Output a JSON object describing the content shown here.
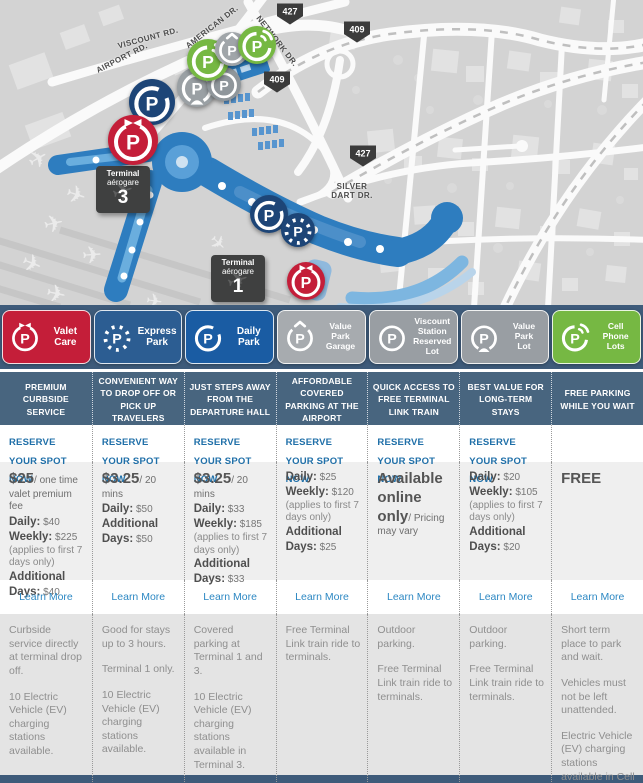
{
  "map": {
    "road_labels": [
      {
        "text": "VISCOUNT RD.",
        "x": 148,
        "y": 38,
        "angle": -15,
        "wrap": false
      },
      {
        "text": "AMERICAN DR.",
        "x": 212,
        "y": 27,
        "angle": -38,
        "wrap": false
      },
      {
        "text": "NETWORK DR.",
        "x": 277,
        "y": 41,
        "angle": 52,
        "wrap": false
      },
      {
        "text": "AIRPORT RD.",
        "x": 122,
        "y": 58,
        "angle": -27,
        "wrap": false
      },
      {
        "text": "SILVER DART DR.",
        "x": 352,
        "y": 191,
        "angle": 0,
        "wrap": true
      }
    ],
    "shields": [
      {
        "label": "427",
        "x": 290,
        "y": 14
      },
      {
        "label": "409",
        "x": 357,
        "y": 32
      },
      {
        "label": "409",
        "x": 277,
        "y": 82
      },
      {
        "label": "427",
        "x": 363,
        "y": 156
      }
    ],
    "terminal_labels": [
      {
        "line1": "Terminal",
        "line2": "aérogare",
        "number": "3",
        "x": 96,
        "y": 166
      },
      {
        "line1": "Terminal",
        "line2": "aérogare",
        "number": "1",
        "x": 211,
        "y": 255
      }
    ],
    "markers": [
      {
        "id": "daily-park-t3",
        "variant": "daily",
        "color": "#1d4577",
        "x": 152,
        "y": 102,
        "d": 46
      },
      {
        "id": "valet-care-t3",
        "variant": "valet",
        "color": "#c41e39",
        "x": 133,
        "y": 140,
        "d": 50
      },
      {
        "id": "value-park-lot",
        "variant": "value-lot",
        "color": "#9aa0a4",
        "x": 197,
        "y": 87,
        "d": 40
      },
      {
        "id": "viscount-station",
        "variant": "viscount",
        "color": "#8f969b",
        "x": 224,
        "y": 84,
        "d": 34
      },
      {
        "id": "cell-phone-lot-1",
        "variant": "cell",
        "color": "#76b843",
        "x": 208,
        "y": 60,
        "d": 42
      },
      {
        "id": "value-park-garage",
        "variant": "garage",
        "color": "#a0a5a9",
        "x": 232,
        "y": 49,
        "d": 34
      },
      {
        "id": "cell-phone-lot-2",
        "variant": "cell",
        "color": "#76b843",
        "x": 257,
        "y": 45,
        "d": 38
      },
      {
        "id": "daily-park-t1",
        "variant": "daily",
        "color": "#1d4577",
        "x": 269,
        "y": 214,
        "d": 38
      },
      {
        "id": "express-park-t1",
        "variant": "express",
        "color": "#1d4577",
        "x": 298,
        "y": 230,
        "d": 34
      },
      {
        "id": "valet-care-t1",
        "variant": "valet",
        "color": "#c41e39",
        "x": 306,
        "y": 281,
        "d": 38
      }
    ]
  },
  "legend": {
    "background": "#3e5b7a",
    "items": [
      {
        "id": "valet-care",
        "label": "Valet\nCare",
        "color": "#c41e39",
        "variant": "valet"
      },
      {
        "id": "express-park",
        "label": "Express\nPark",
        "color": "#2c5d92",
        "variant": "express"
      },
      {
        "id": "daily-park",
        "label": "Daily\nPark",
        "color": "#1a5ca3",
        "variant": "daily"
      },
      {
        "id": "value-park-garage",
        "label": "Value\nPark\nGarage",
        "color": "#a7abaf",
        "variant": "garage"
      },
      {
        "id": "viscount-station-reserved-lot",
        "label": "Viscount\nStation\nReserved Lot",
        "color": "#999ea3",
        "variant": "viscount"
      },
      {
        "id": "value-park-lot",
        "label": "Value\nPark\nLot",
        "color": "#999ea3",
        "variant": "value-lot"
      },
      {
        "id": "cell-phone-lots",
        "label": "Cell\nPhone\nLots",
        "color": "#76b843",
        "variant": "cell"
      }
    ]
  },
  "columns": [
    {
      "id": "valet-care",
      "header": "PREMIUM CURBSIDE SERVICE",
      "reserve": "RESERVE YOUR SPOT NOW",
      "pricing": [
        {
          "lead": "$25",
          "rest": "/ one time valet premium fee"
        },
        {
          "label": "Daily:",
          "value": "$40"
        },
        {
          "label": "Weekly:",
          "value": "$225"
        },
        {
          "note": "(applies to first 7 days only)"
        },
        {
          "label": "Additional Days:",
          "value": "$40"
        }
      ],
      "learn_more": "Learn More",
      "description": [
        "Curbside service directly at terminal drop off.",
        "10 Electric Vehicle (EV) charging stations available."
      ]
    },
    {
      "id": "express-park",
      "header": "CONVENIENT WAY TO DROP OFF OR PICK UP TRAVELERS",
      "reserve": "RESERVE YOUR SPOT NOW",
      "pricing": [
        {
          "lead": "$3.25",
          "rest": "/ 20 mins"
        },
        {
          "label": "Daily:",
          "value": "$50"
        },
        {
          "label": "Additional Days:",
          "value": "$50"
        }
      ],
      "learn_more": "Learn More",
      "description": [
        "Good for stays up to 3 hours.",
        "Terminal 1 only.",
        "10 Electric Vehicle (EV) charging stations available."
      ]
    },
    {
      "id": "daily-park",
      "header": "JUST STEPS AWAY FROM THE DEPARTURE HALL",
      "reserve": "RESERVE YOUR SPOT NOW",
      "pricing": [
        {
          "lead": "$3.25",
          "rest": "/ 20 mins"
        },
        {
          "label": "Daily:",
          "value": "$33"
        },
        {
          "label": "Weekly:",
          "value": "$185"
        },
        {
          "note": "(applies to first 7 days only)"
        },
        {
          "label": "Additional Days:",
          "value": "$33"
        }
      ],
      "learn_more": "Learn More",
      "description": [
        "Covered parking at Terminal 1 and 3.",
        "10 Electric Vehicle (EV) charging stations available in Terminal 3."
      ]
    },
    {
      "id": "value-park-garage",
      "header": "AFFORDABLE COVERED PARKING AT THE AIRPORT",
      "reserve": "RESERVE YOUR SPOT NOW",
      "pricing": [
        {
          "label": "Daily:",
          "value": "$25"
        },
        {
          "label": "Weekly:",
          "value": "$120"
        },
        {
          "note": "(applies to first 7 days only)"
        },
        {
          "label": "Additional Days:",
          "value": "$25"
        }
      ],
      "learn_more": "Learn More",
      "description": [
        "Free Terminal Link train ride to terminals."
      ]
    },
    {
      "id": "viscount-station-reserved-lot",
      "header": "QUICK ACCESS TO FREE TERMINAL LINK TRAIN",
      "reserve": "RESERVE YOUR SPOT NOW",
      "pricing": [
        {
          "lead": "Available online only",
          "rest": "/ Pricing may vary"
        }
      ],
      "learn_more": "Learn More",
      "description": [
        "Outdoor parking.",
        "Free Terminal Link train ride to terminals."
      ]
    },
    {
      "id": "value-park-lot",
      "header": "BEST VALUE FOR LONG-TERM STAYS",
      "reserve": "RESERVE YOUR SPOT NOW",
      "pricing": [
        {
          "label": "Daily:",
          "value": "$20"
        },
        {
          "label": "Weekly:",
          "value": "$105"
        },
        {
          "note": "(applies to first 7 days only)"
        },
        {
          "label": "Additional Days:",
          "value": "$20"
        }
      ],
      "learn_more": "Learn More",
      "description": [
        "Outdoor parking.",
        "Free Terminal Link train ride to terminals."
      ]
    },
    {
      "id": "cell-phone-lots",
      "header": "FREE PARKING WHILE YOU WAIT",
      "reserve": "",
      "pricing": [
        {
          "lead": "FREE",
          "rest": ""
        }
      ],
      "learn_more": "Learn More",
      "description": [
        "Short term place to park and wait.",
        "Vehicles must not be left unattended.",
        "Electric Vehicle (EV) charging stations available in Cell Phone Lot 2."
      ]
    }
  ]
}
